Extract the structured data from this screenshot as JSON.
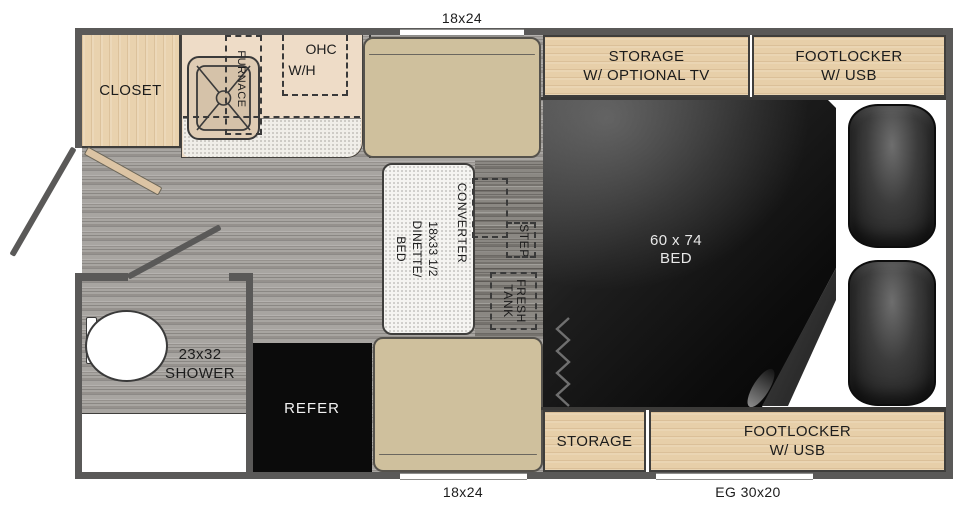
{
  "plan": {
    "exterior": {
      "window_top": "18x24",
      "window_bottom": "18x24",
      "window_eg": "EG 30x20"
    },
    "kitchen": {
      "closet": "CLOSET",
      "furnace": "FURNACE",
      "ohc": "OHC",
      "water_heater": "W/H"
    },
    "dinette": {
      "converter": "CONVERTER",
      "size": "18x33 1/2",
      "name1": "DINETTE/",
      "name2": "BED",
      "step": "STEP",
      "fresh1": "FRESH",
      "fresh2": "TANK"
    },
    "bed": {
      "size": "60 x 74",
      "name": "BED"
    },
    "bath": {
      "size": "23x32",
      "name": "SHOWER"
    },
    "galley": {
      "refer": "REFER"
    },
    "storage": {
      "top1": "STORAGE",
      "top2": "W/ OPTIONAL TV",
      "fl_top1": "FOOTLOCKER",
      "fl_top2": "W/ USB",
      "bottom": "STORAGE",
      "fl_bottom1": "FOOTLOCKER",
      "fl_bottom2": "W/ USB"
    },
    "colors": {
      "wall": "#5a5958",
      "wood": "#e9d2ae",
      "bench": "#cfc09d",
      "counter": "#eedcc7",
      "bed": "#0a0a0a",
      "floor": "#a8a5a1"
    }
  }
}
